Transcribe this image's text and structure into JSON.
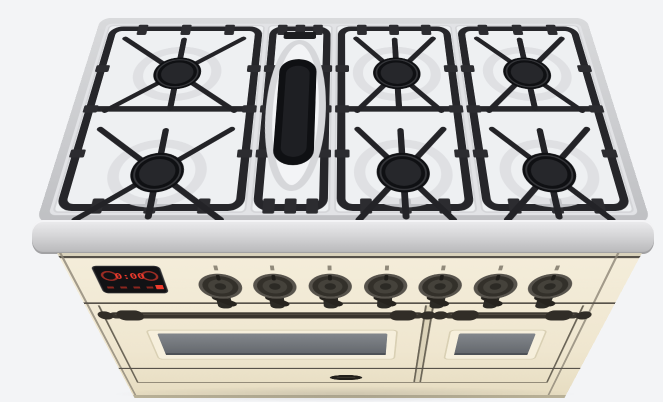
{
  "scene": {
    "type": "3d-product-render",
    "subject": "Freestanding dual-fuel range cooker with cream enamel finish, six gas burners plus central griddle burner, viewed from the top front",
    "background_color": "#f3f4f6"
  },
  "cooktop": {
    "rim_color": "#c9cacd",
    "enamel_color": "#eef0f2",
    "grate_color": "#26262a",
    "burner_cap_color": "#0f1013",
    "burners": [
      {
        "id": "left-rear",
        "shape": "round"
      },
      {
        "id": "left-front",
        "shape": "round"
      },
      {
        "id": "griddle-center",
        "shape": "oval"
      },
      {
        "id": "middle-rear",
        "shape": "round"
      },
      {
        "id": "middle-front",
        "shape": "round"
      },
      {
        "id": "right-rear",
        "shape": "round"
      },
      {
        "id": "right-front",
        "shape": "round"
      }
    ]
  },
  "control_panel": {
    "panel_color": "#f1e9d3",
    "trim_color": "#57524a",
    "display": {
      "body_color": "#121215",
      "accent_color": "#ef3b2d",
      "clock_value": "0:00",
      "left_icon": "timer-icon",
      "right_icon": "program-icon",
      "button_count": 4
    },
    "knobs": [
      {
        "id": "knob-1"
      },
      {
        "id": "knob-2"
      },
      {
        "id": "knob-3"
      },
      {
        "id": "knob-4"
      },
      {
        "id": "knob-5"
      },
      {
        "id": "knob-6"
      },
      {
        "id": "knob-7"
      }
    ]
  },
  "ovens": {
    "handle_color": "#38342d",
    "glass_color": "#71757a",
    "left_door": {
      "id": "left-oven-door"
    },
    "right_door": {
      "id": "right-oven-door"
    }
  },
  "base": {
    "logo_badge_color": "#221f1a"
  }
}
